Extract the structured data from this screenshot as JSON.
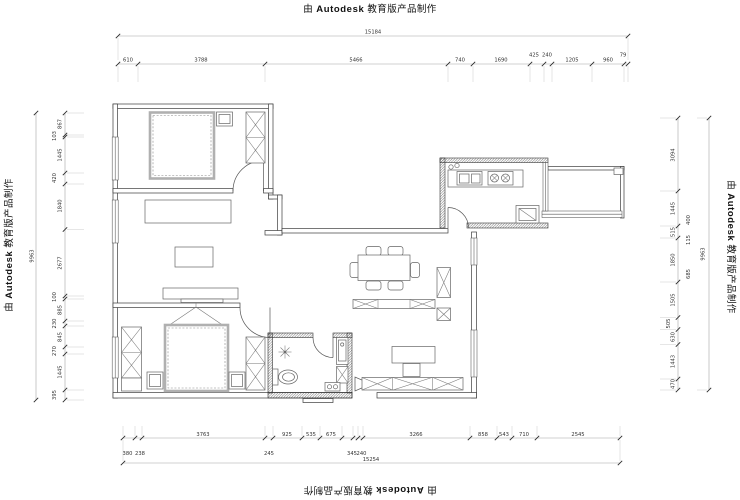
{
  "watermark": {
    "prefix": "由",
    "brand": "Autodesk",
    "suffix": "教育版产品制作"
  },
  "dims": {
    "top": {
      "total": "15184",
      "segments": [
        "610",
        "3788",
        "5466",
        "740",
        "1690",
        "425",
        "240",
        "1205",
        "960",
        "79"
      ]
    },
    "bottom": {
      "total": "15254",
      "row1": [
        "3763",
        "925",
        "535",
        "675",
        "3266",
        "858",
        "543",
        "710",
        "2545"
      ],
      "row2": [
        "380",
        "238",
        "245",
        "345",
        "240"
      ]
    },
    "left": {
      "total": "9963",
      "segments": [
        "867",
        "103",
        "1445",
        "420",
        "1840",
        "2677",
        "100",
        "885",
        "230",
        "845",
        "270",
        "1445",
        "395"
      ]
    },
    "right": {
      "total": "9963",
      "segments": [
        "3094",
        "1445",
        "515",
        "1850",
        "1505",
        "505",
        "630",
        "1443",
        "470"
      ],
      "inner": [
        "400",
        "115",
        "685"
      ]
    }
  }
}
